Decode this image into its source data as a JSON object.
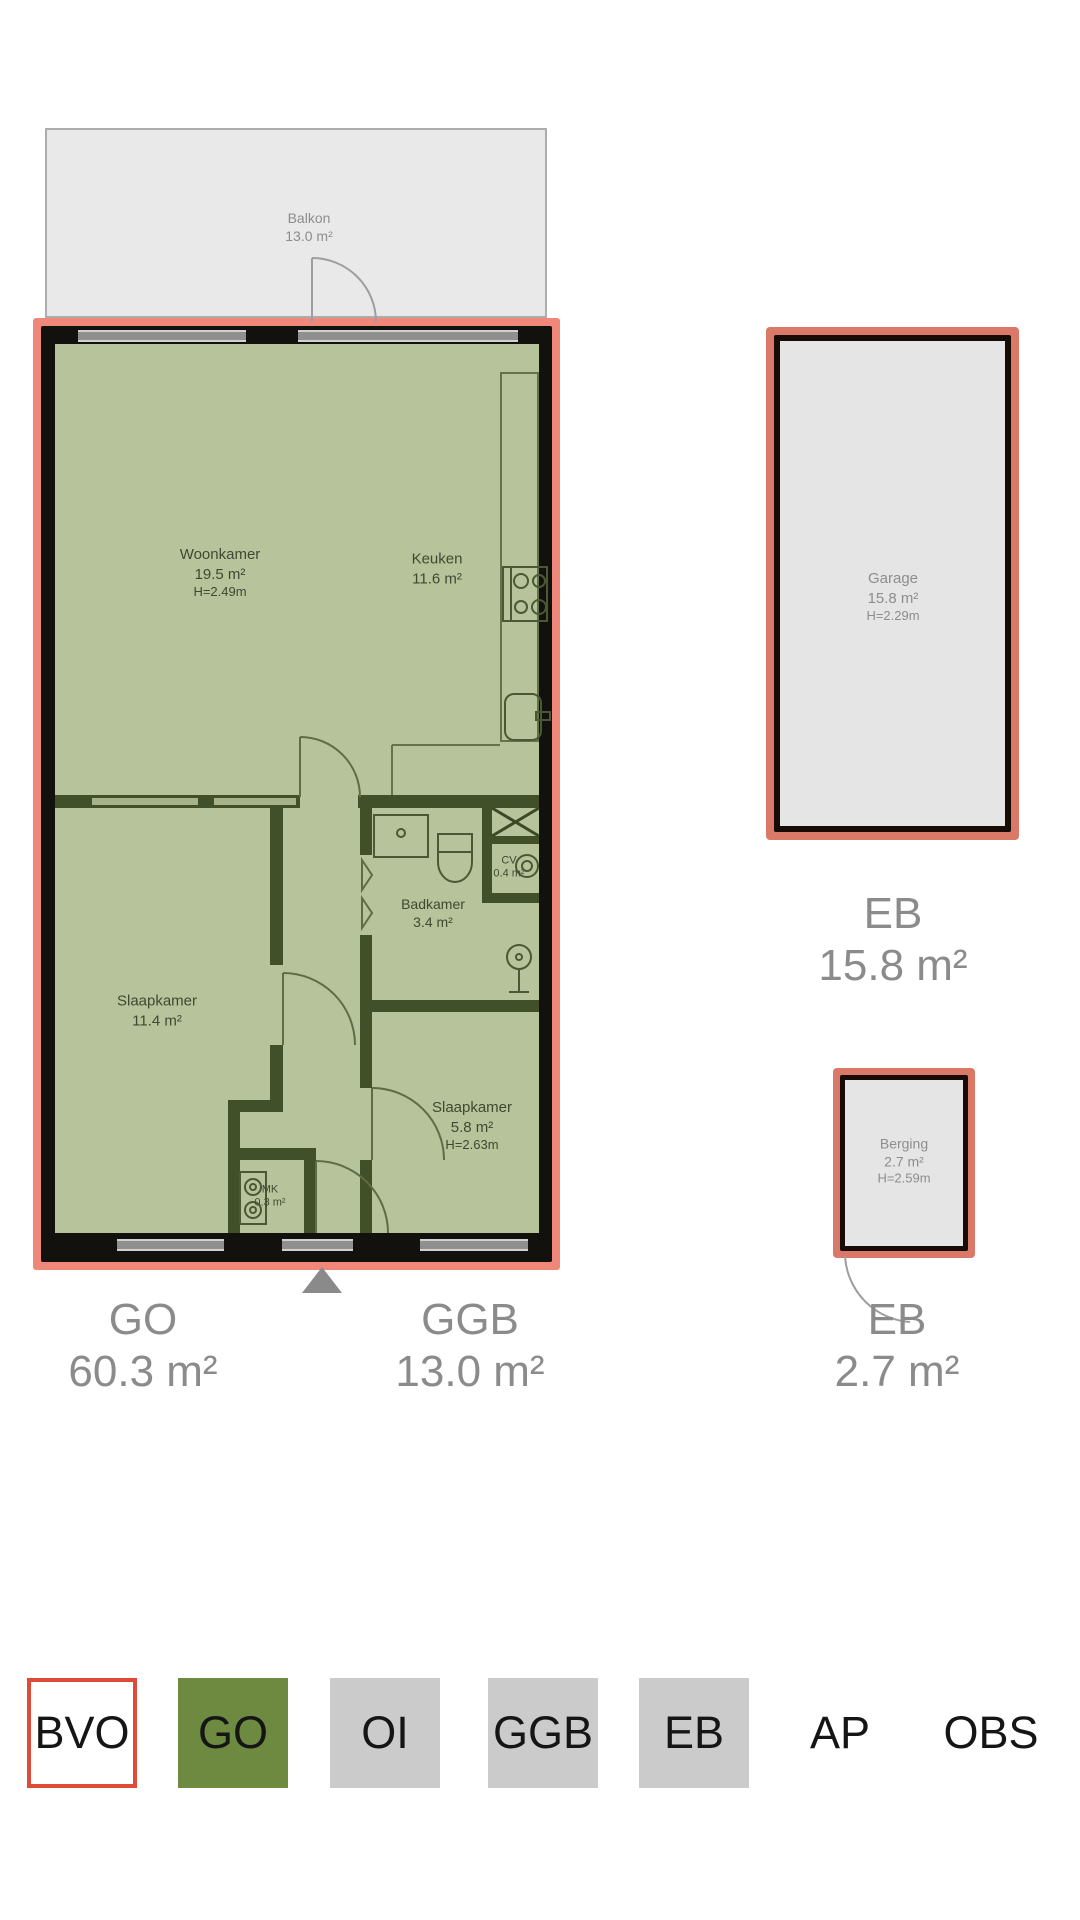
{
  "floorplan": {
    "balcony": {
      "name": "Balkon",
      "area": "13.0 m²"
    },
    "rooms": {
      "woonkamer": {
        "name": "Woonkamer",
        "area": "19.5 m²",
        "height": "H=2.49m"
      },
      "keuken": {
        "name": "Keuken",
        "area": "11.6 m²"
      },
      "badkamer": {
        "name": "Badkamer",
        "area": "3.4 m²"
      },
      "cv": {
        "name": "CV",
        "area": "0.4 m²"
      },
      "slaapkamer1": {
        "name": "Slaapkamer",
        "area": "11.4 m²"
      },
      "slaapkamer2": {
        "name": "Slaapkamer",
        "area": "5.8 m²",
        "height": "H=2.63m"
      },
      "mk": {
        "name": "MK",
        "area": "0.3 m²"
      }
    },
    "garage": {
      "name": "Garage",
      "area": "15.8 m²",
      "height": "H=2.29m"
    },
    "berging": {
      "name": "Berging",
      "area": "2.7 m²",
      "height": "H=2.59m"
    }
  },
  "measurements": {
    "go": {
      "label": "GO",
      "value": "60.3 m²"
    },
    "ggb": {
      "label": "GGB",
      "value": "13.0 m²"
    },
    "eb_garage": {
      "label": "EB",
      "value": "15.8 m²"
    },
    "eb_berging": {
      "label": "EB",
      "value": "2.7 m²"
    }
  },
  "legend": {
    "items": [
      {
        "label": "BVO",
        "style": "outlined-red"
      },
      {
        "label": "GO",
        "style": "green"
      },
      {
        "label": "OI",
        "style": "gray"
      },
      {
        "label": "GGB",
        "style": "gray"
      },
      {
        "label": "EB",
        "style": "gray"
      },
      {
        "label": "AP",
        "style": "plain"
      },
      {
        "label": "OBS",
        "style": "plain"
      }
    ]
  },
  "colors": {
    "bvo_outline": "#f0887a",
    "room_fill_go": "#b7c39b",
    "interior_wall": "#42502a",
    "exterior_wall": "#13110e",
    "eb_fill": "#e5e5e5",
    "legend_green": "#6d8a40",
    "legend_gray": "#cbcbcb",
    "legend_red_border": "#e04b38",
    "measurement_text": "#8b8b8b",
    "room_label_text": "#3e4931"
  }
}
